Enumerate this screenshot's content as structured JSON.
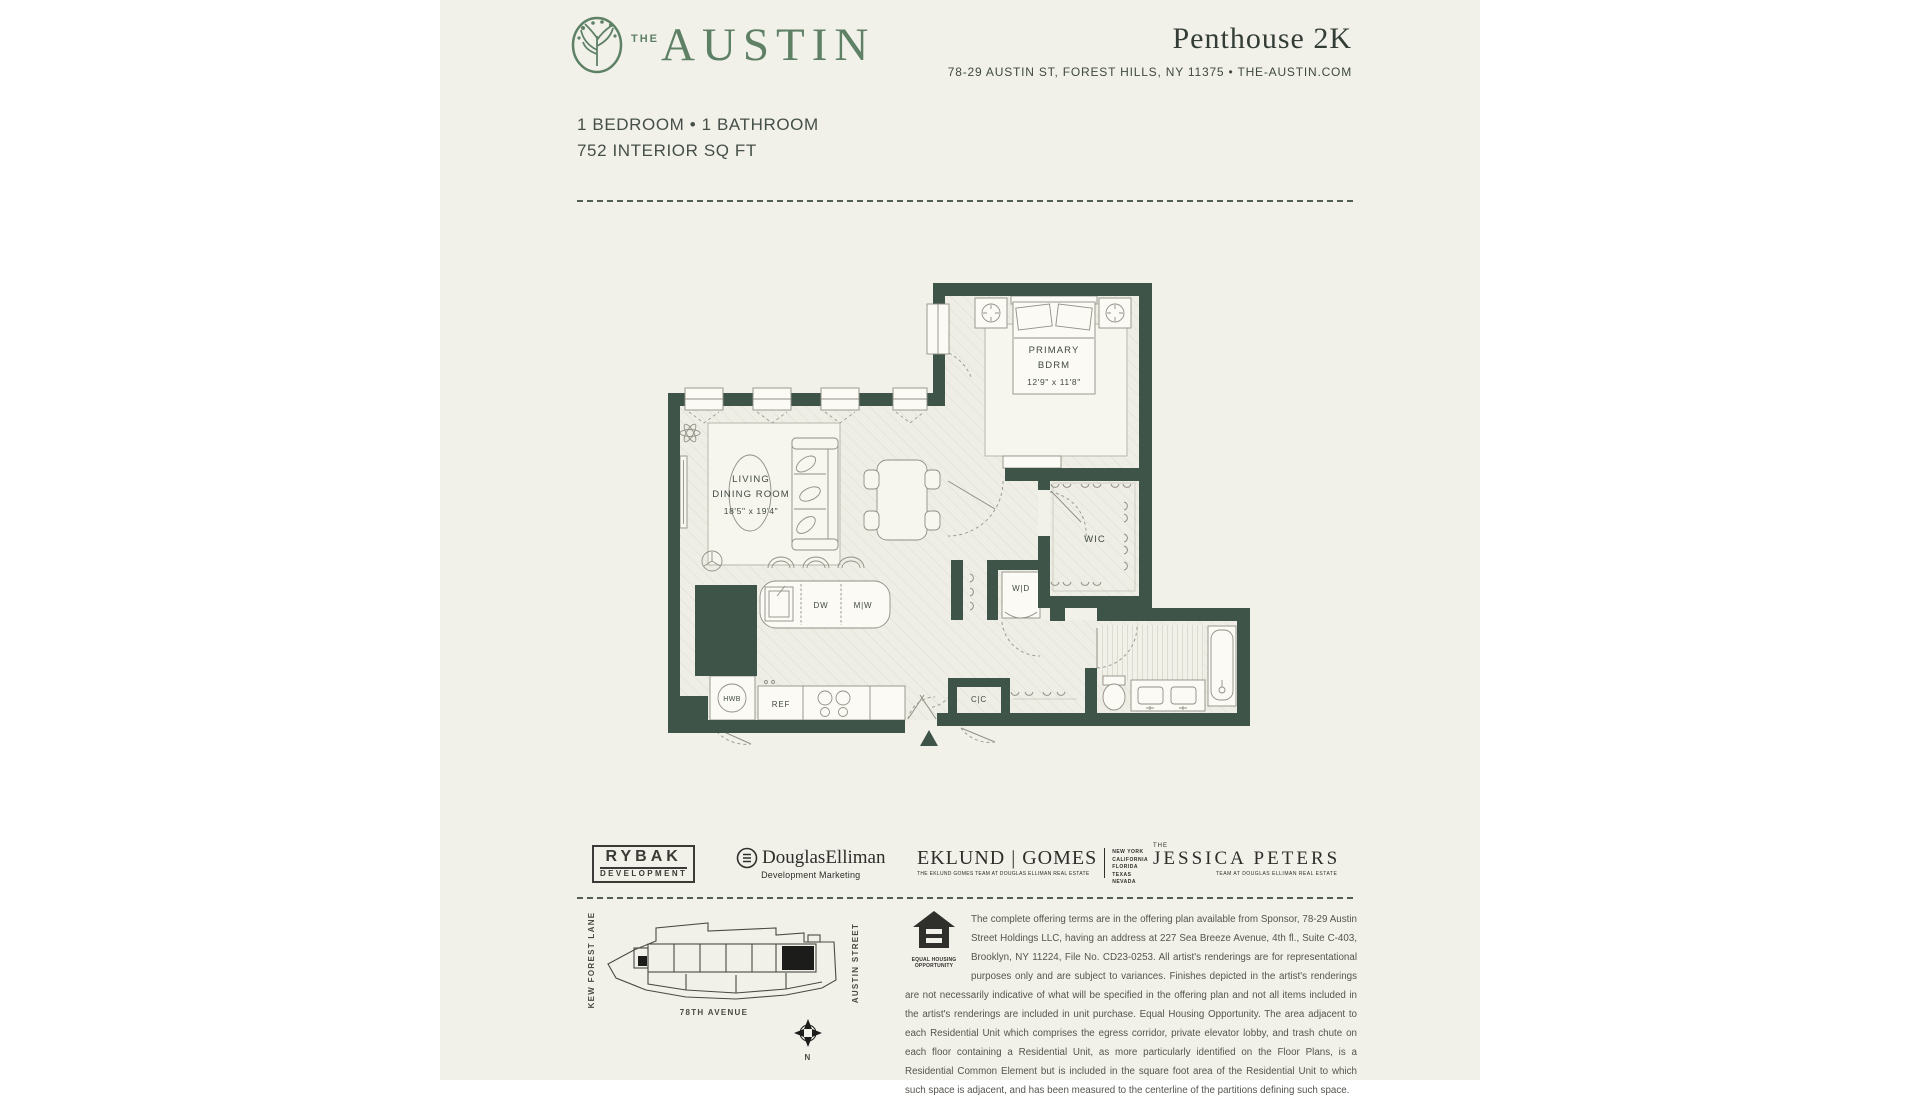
{
  "header": {
    "brand_the": "THE",
    "brand_name": "AUSTIN",
    "unit_title": "Penthouse 2K",
    "address_line": "78-29 AUSTIN ST, FOREST HILLS, NY 11375 • THE-AUSTIN.COM"
  },
  "specs": {
    "line1": "1 BEDROOM • 1 BATHROOM",
    "line2": "752 INTERIOR SQ FT"
  },
  "floor_plan": {
    "primary_bedroom": {
      "line1": "PRIMARY",
      "line2": "BDRM",
      "dims": "12'9\" x 11'8\""
    },
    "living_dining": {
      "line1": "LIVING",
      "line2": "DINING ROOM",
      "dims": "18'5\" x 19'4\""
    },
    "wic": "WIC",
    "washer_dryer": "W|D",
    "coat_closet": "C|C",
    "dishwasher": "DW",
    "microwave": "M|W",
    "refrigerator": "REF",
    "hot_water": "HWB"
  },
  "logos": {
    "rybak": {
      "line1": "RYBAK",
      "line2": "DEVELOPMENT"
    },
    "douglas_elliman": {
      "name": "DouglasElliman",
      "tagline": "Development Marketing"
    },
    "eklund_gomes": {
      "name": "EKLUND | GOMES",
      "tagline": "THE EKLUND GOMES TEAM AT DOUGLAS ELLIMAN REAL ESTATE",
      "regions": [
        "NEW YORK",
        "CALIFORNIA",
        "FLORIDA",
        "TEXAS",
        "NEVADA"
      ]
    },
    "jessica_peters": {
      "the": "THE",
      "name": "JESSICA PETERS",
      "tagline": "TEAM AT DOUGLAS ELLIMAN REAL ESTATE"
    }
  },
  "site_map": {
    "street_left": "KEW FOREST LANE",
    "street_right": "AUSTIN STREET",
    "street_bottom": "78TH AVENUE",
    "compass": "N"
  },
  "disclaimer": {
    "eho_caption": "EQUAL HOUSING OPPORTUNITY",
    "text": "The complete offering terms are in the offering plan available from Sponsor, 78-29 Austin Street Holdings LLC, having an address at 227 Sea Breeze Avenue, 4th fl., Suite C-403, Brooklyn, NY 11224, File No. CD23-0253. All artist's renderings are for representational purposes only and are subject to variances. Finishes depicted in the artist's renderings are not necessarily indicative of what will be specified in the offering plan and not all items included in the artist's renderings are included in unit purchase. Equal Housing Opportunity. The area adjacent to each Residential Unit which comprises the egress corridor, private elevator lobby, and trash chute on each floor containing a Residential Unit, as more particularly identified on the Floor Plans, is a Residential Common Element but is included in the square foot area of the Residential Unit to which such space is adjacent, and has been measured to the centerline of the partitions defining such space."
  },
  "colors": {
    "brand_green": "#5e8166",
    "wall_green": "#3f5449",
    "page_cream": "#f1f1ea",
    "ink": "#333d35"
  }
}
